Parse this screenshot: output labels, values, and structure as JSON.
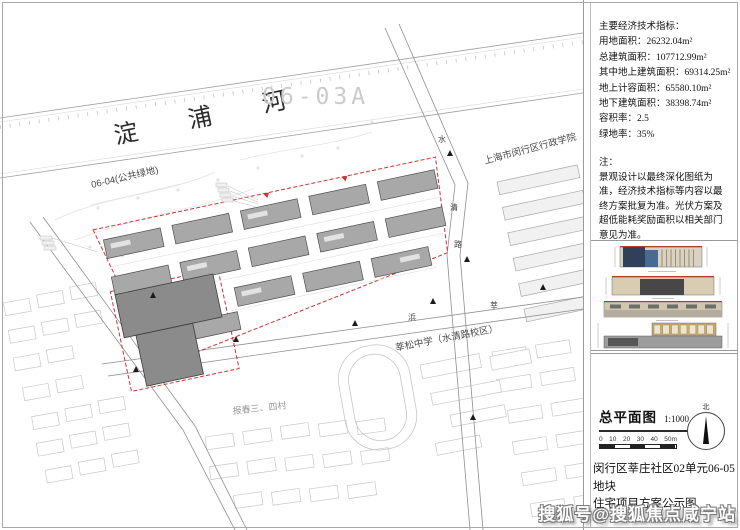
{
  "colors": {
    "boundary_red": "#cc3333",
    "building_gray": "#a8a8a8",
    "dark_building": "#8b8b8b"
  },
  "map": {
    "river_label": "淀 浦 河",
    "parcel_0603a_label": "06-03A",
    "parcel_0604_label": "06-04(公共绿地)",
    "college_label": "上海市闵行区行政学院",
    "school_label": "莘松中学（水清路校区）",
    "village_label": "报春三、四村",
    "road_east_chars": [
      "水",
      "清",
      "路"
    ],
    "road_south_chars": [
      "莘",
      "浜",
      "路"
    ]
  },
  "panel": {
    "indicators": {
      "lines": [
        "主要经济技术指标：",
        "用地面积：26232.04m²",
        "总建筑面积：107712.99m²",
        "其中地上建筑面积：69314.25m²",
        "地上计容面积：65580.10m²",
        "地下建筑面积：38398.74m²",
        "容积率：2.5",
        "绿地率：35%"
      ]
    },
    "note": {
      "label": "注：",
      "text": "景观设计以最终深化图纸为准，经济技术指标等内容以最终方案批复为准。光伏方案及超低能耗奖励面积以相关部门意见为准。"
    },
    "titleblock": {
      "title": "总平面图",
      "scale": "1:1000",
      "scalebar_labels": [
        "0",
        "10",
        "20",
        "30",
        "40",
        "50m"
      ],
      "north_label": "北",
      "caption_line1": "闵行区莘庄社区02单元06-05地块",
      "caption_line2": "住宅项目方案公示图"
    }
  },
  "watermark": "搜狐号@搜狐焦点咸宁站"
}
